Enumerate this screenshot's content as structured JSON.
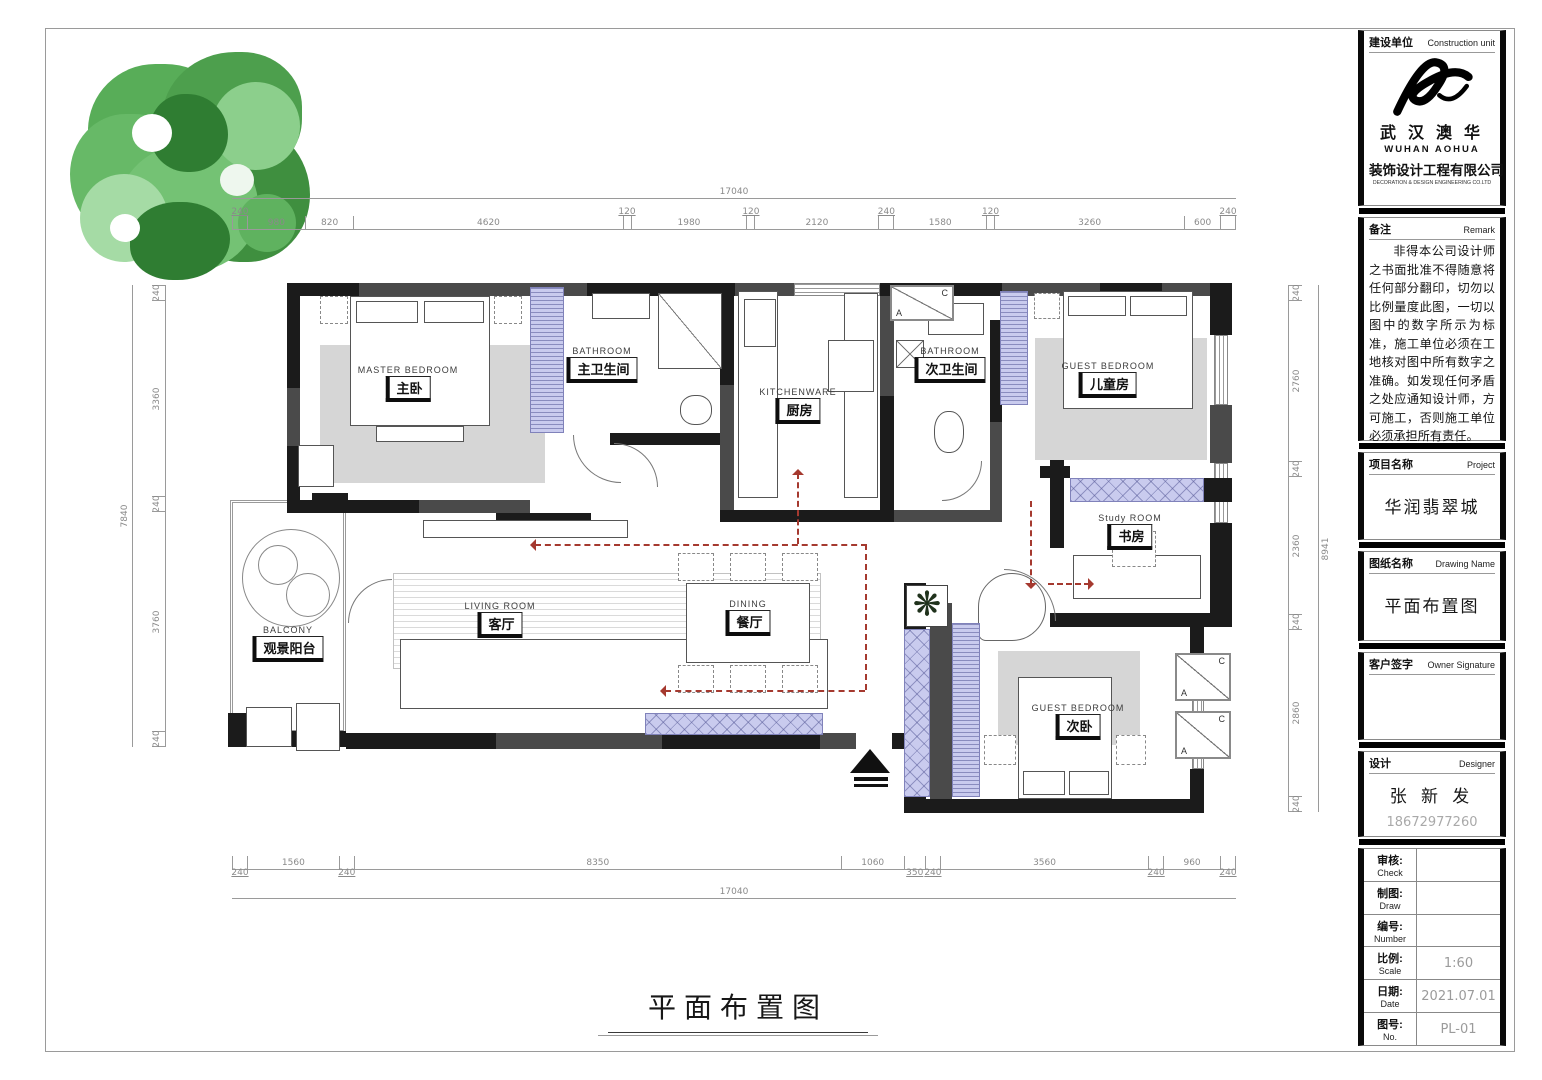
{
  "plan": {
    "bottom_title": "平面布置图",
    "rooms": [
      {
        "en": "MASTER  BEDROOM",
        "zh": "主卧"
      },
      {
        "en": "BATHROOM",
        "zh": "主卫生间"
      },
      {
        "en": "KITCHENWARE",
        "zh": "厨房"
      },
      {
        "en": "BATHROOM",
        "zh": "次卫生间"
      },
      {
        "en": "GUEST  BEDROOM",
        "zh": "儿童房"
      },
      {
        "en": "Study  ROOM",
        "zh": "书房"
      },
      {
        "en": "LIVING  ROOM",
        "zh": "客厅"
      },
      {
        "en": "DINING",
        "zh": "餐厅"
      },
      {
        "en": "BALCONY",
        "zh": "观景阳台"
      },
      {
        "en": "GUEST  BEDROOM",
        "zh": "次卧"
      }
    ],
    "ac_letters": {
      "a": "A",
      "c": "C"
    },
    "dims": {
      "top_total": "17040",
      "bottom_total": "17040",
      "left_total": "7840",
      "right_total": "8941",
      "top": [
        240,
        980,
        820,
        4620,
        120,
        1980,
        120,
        2120,
        240,
        1580,
        120,
        3260,
        600,
        240
      ],
      "bottom": [
        240,
        1560,
        240,
        8350,
        1060,
        350,
        240,
        3560,
        240,
        960,
        240
      ],
      "left": [
        240,
        3360,
        240,
        3760,
        240
      ],
      "right": [
        240,
        2760,
        240,
        2360,
        240,
        2860,
        240
      ]
    }
  },
  "title_block": {
    "construction_unit": {
      "label_zh": "建设单位",
      "label_en": "Construction unit",
      "company_zh": "武 汉 澳 华",
      "company_en": "WUHAN  AOHUA",
      "company_zh2": "装饰设计工程有限公司",
      "company_en2": "DECORATION & DESIGN ENGINEERING CO.LTD"
    },
    "remark": {
      "label_zh": "备注",
      "label_en": "Remark",
      "text": "非得本公司设计师之书面批准不得随意将任何部分翻印，切勿以比例量度此图，一切以图中的数字所示为标准，施工单位必须在工地核对图中所有数字之准确。如发现任何矛盾之处应通知设计师，方可施工，否则施工单位必须承担所有责任。"
    },
    "project": {
      "label_zh": "项目名称",
      "label_en": "Project",
      "value": "华润翡翠城"
    },
    "drawing_name": {
      "label_zh": "图纸名称",
      "label_en": "Drawing Name",
      "value": "平面布置图"
    },
    "owner_signature": {
      "label_zh": "客户签字",
      "label_en": "Owner Signature"
    },
    "designer": {
      "label_zh": "设计",
      "label_en": "Designer",
      "name": "张 新 发",
      "phone": "18672977260"
    },
    "info_rows": [
      {
        "zh": "审核:",
        "en": "Check",
        "value": ""
      },
      {
        "zh": "制图:",
        "en": "Draw",
        "value": ""
      },
      {
        "zh": "编号:",
        "en": "Number",
        "value": ""
      },
      {
        "zh": "比例:",
        "en": "Scale",
        "value": "1:60"
      },
      {
        "zh": "日期:",
        "en": "Date",
        "value": "2021.07.01"
      },
      {
        "zh": "图号:",
        "en": "No.",
        "value": "PL-01"
      }
    ]
  },
  "colors": {
    "wall": "#1b1b1b",
    "cabinet_purple": "#c9cbee",
    "furniture_gray": "#d6d6d6",
    "tree_green": "#4ca64c",
    "arrow_red": "#a5392f"
  }
}
